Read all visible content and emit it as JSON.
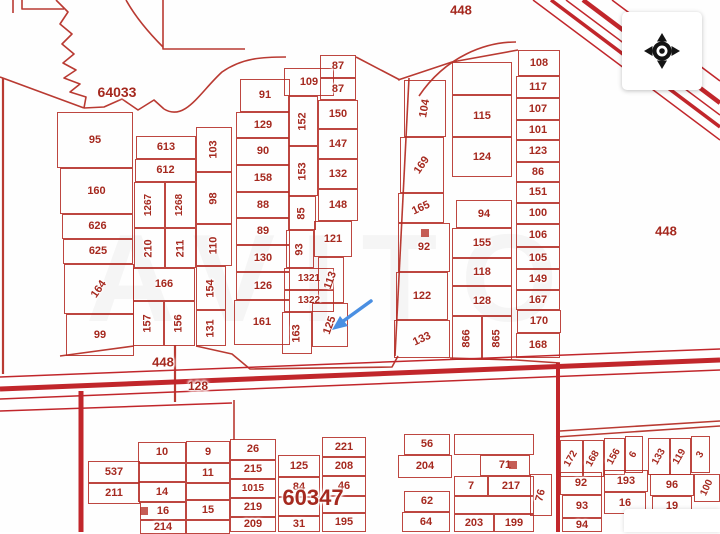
{
  "map": {
    "watermark_text": "AVITO",
    "colors": {
      "parcel_line": "#b42c25",
      "label": "#a5291f",
      "road": "#c01d23",
      "arrow": "#4a8fe2",
      "compass_icon": "#141414"
    },
    "region_labels": [
      {
        "text": "64033",
        "x": 117,
        "y": 92,
        "fs": 14
      },
      {
        "text": "448",
        "x": 461,
        "y": 10,
        "fs": 13
      },
      {
        "text": "448",
        "x": 666,
        "y": 231,
        "fs": 13
      },
      {
        "text": "448",
        "x": 163,
        "y": 362,
        "fs": 13
      },
      {
        "text": "128",
        "x": 198,
        "y": 386,
        "fs": 12
      },
      {
        "text": "60347",
        "x": 313,
        "y": 498,
        "fs": 22
      }
    ],
    "plots": [
      {
        "t": "95",
        "x": 57,
        "y": 112,
        "w": 76,
        "h": 56
      },
      {
        "t": "160",
        "x": 60,
        "y": 168,
        "w": 73,
        "h": 46
      },
      {
        "t": "626",
        "x": 62,
        "y": 214,
        "w": 71,
        "h": 25
      },
      {
        "t": "625",
        "x": 63,
        "y": 239,
        "w": 70,
        "h": 25
      },
      {
        "t": "164",
        "x": 64,
        "y": 264,
        "w": 70,
        "h": 50,
        "r": -55
      },
      {
        "t": "99",
        "x": 66,
        "y": 314,
        "w": 68,
        "h": 42
      },
      {
        "t": "613",
        "x": 136,
        "y": 136,
        "w": 60,
        "h": 23
      },
      {
        "t": "612",
        "x": 135,
        "y": 159,
        "w": 61,
        "h": 23
      },
      {
        "t": "1267",
        "x": 134,
        "y": 182,
        "w": 31,
        "h": 46,
        "r": -90,
        "fs": 10
      },
      {
        "t": "1268",
        "x": 165,
        "y": 182,
        "w": 31,
        "h": 46,
        "r": -90,
        "fs": 10
      },
      {
        "t": "210",
        "x": 134,
        "y": 228,
        "w": 31,
        "h": 40,
        "r": -90
      },
      {
        "t": "211",
        "x": 165,
        "y": 228,
        "w": 31,
        "h": 40,
        "r": -90
      },
      {
        "t": "166",
        "x": 133,
        "y": 268,
        "w": 62,
        "h": 33
      },
      {
        "t": "157",
        "x": 133,
        "y": 301,
        "w": 31,
        "h": 45,
        "r": -90
      },
      {
        "t": "156",
        "x": 164,
        "y": 301,
        "w": 31,
        "h": 45,
        "r": -90
      },
      {
        "t": "103",
        "x": 196,
        "y": 127,
        "w": 36,
        "h": 45,
        "r": -90
      },
      {
        "t": "98",
        "x": 196,
        "y": 172,
        "w": 36,
        "h": 52,
        "r": -90
      },
      {
        "t": "110",
        "x": 196,
        "y": 224,
        "w": 36,
        "h": 42,
        "r": -90
      },
      {
        "t": "154",
        "x": 196,
        "y": 266,
        "w": 30,
        "h": 44,
        "r": -90
      },
      {
        "t": "131",
        "x": 196,
        "y": 310,
        "w": 30,
        "h": 36,
        "r": -90
      },
      {
        "t": "91",
        "x": 240,
        "y": 79,
        "w": 50,
        "h": 33
      },
      {
        "t": "129",
        "x": 236,
        "y": 112,
        "w": 54,
        "h": 26
      },
      {
        "t": "90",
        "x": 236,
        "y": 138,
        "w": 54,
        "h": 27
      },
      {
        "t": "158",
        "x": 236,
        "y": 165,
        "w": 54,
        "h": 27
      },
      {
        "t": "88",
        "x": 236,
        "y": 192,
        "w": 54,
        "h": 26
      },
      {
        "t": "89",
        "x": 236,
        "y": 218,
        "w": 54,
        "h": 27
      },
      {
        "t": "130",
        "x": 236,
        "y": 245,
        "w": 54,
        "h": 27
      },
      {
        "t": "126",
        "x": 236,
        "y": 272,
        "w": 54,
        "h": 28
      },
      {
        "t": "161",
        "x": 234,
        "y": 300,
        "w": 56,
        "h": 45
      },
      {
        "t": "109",
        "x": 284,
        "y": 68,
        "w": 50,
        "h": 28
      },
      {
        "t": "87",
        "x": 320,
        "y": 55,
        "w": 36,
        "h": 23
      },
      {
        "t": "87",
        "x": 320,
        "y": 78,
        "w": 36,
        "h": 22
      },
      {
        "t": "152",
        "x": 288,
        "y": 96,
        "w": 30,
        "h": 50,
        "r": -90
      },
      {
        "t": "150",
        "x": 318,
        "y": 100,
        "w": 40,
        "h": 29
      },
      {
        "t": "153",
        "x": 288,
        "y": 146,
        "w": 30,
        "h": 50,
        "r": -90
      },
      {
        "t": "147",
        "x": 318,
        "y": 129,
        "w": 40,
        "h": 30
      },
      {
        "t": "132",
        "x": 318,
        "y": 159,
        "w": 40,
        "h": 30
      },
      {
        "t": "85",
        "x": 288,
        "y": 196,
        "w": 28,
        "h": 34,
        "r": -90
      },
      {
        "t": "148",
        "x": 318,
        "y": 189,
        "w": 40,
        "h": 32
      },
      {
        "t": "93",
        "x": 286,
        "y": 230,
        "w": 28,
        "h": 38,
        "r": -90
      },
      {
        "t": "121",
        "x": 314,
        "y": 221,
        "w": 38,
        "h": 36
      },
      {
        "t": "1321",
        "x": 284,
        "y": 268,
        "w": 50,
        "h": 22,
        "fs": 10
      },
      {
        "t": "113",
        "x": 318,
        "y": 257,
        "w": 26,
        "h": 46,
        "r": -70
      },
      {
        "t": "1322",
        "x": 284,
        "y": 290,
        "w": 50,
        "h": 22,
        "fs": 10
      },
      {
        "t": "163",
        "x": 282,
        "y": 312,
        "w": 30,
        "h": 42,
        "r": -90
      },
      {
        "t": "125",
        "x": 312,
        "y": 303,
        "w": 36,
        "h": 44,
        "r": -70
      },
      {
        "t": "104",
        "x": 404,
        "y": 80,
        "w": 42,
        "h": 57,
        "r": -80
      },
      {
        "t": "169",
        "x": 400,
        "y": 137,
        "w": 44,
        "h": 56,
        "r": -55
      },
      {
        "t": "165",
        "x": 398,
        "y": 193,
        "w": 46,
        "h": 30,
        "r": -25
      },
      {
        "t": "92",
        "x": 398,
        "y": 223,
        "w": 52,
        "h": 49
      },
      {
        "t": "122",
        "x": 396,
        "y": 272,
        "w": 52,
        "h": 48
      },
      {
        "t": "133",
        "x": 394,
        "y": 320,
        "w": 56,
        "h": 38,
        "r": -25
      },
      {
        "t": "",
        "x": 452,
        "y": 62,
        "w": 60,
        "h": 33
      },
      {
        "t": "115",
        "x": 452,
        "y": 95,
        "w": 60,
        "h": 42
      },
      {
        "t": "124",
        "x": 452,
        "y": 137,
        "w": 60,
        "h": 40
      },
      {
        "t": "94",
        "x": 456,
        "y": 200,
        "w": 56,
        "h": 28
      },
      {
        "t": "155",
        "x": 452,
        "y": 228,
        "w": 60,
        "h": 30
      },
      {
        "t": "118",
        "x": 452,
        "y": 258,
        "w": 60,
        "h": 28
      },
      {
        "t": "128",
        "x": 452,
        "y": 286,
        "w": 60,
        "h": 30
      },
      {
        "t": "866",
        "x": 452,
        "y": 316,
        "w": 30,
        "h": 44,
        "r": -90
      },
      {
        "t": "865",
        "x": 482,
        "y": 316,
        "w": 30,
        "h": 44,
        "r": -90
      },
      {
        "t": "108",
        "x": 518,
        "y": 50,
        "w": 42,
        "h": 26
      },
      {
        "t": "117",
        "x": 516,
        "y": 76,
        "w": 44,
        "h": 22
      },
      {
        "t": "107",
        "x": 516,
        "y": 98,
        "w": 44,
        "h": 22
      },
      {
        "t": "101",
        "x": 516,
        "y": 120,
        "w": 44,
        "h": 20
      },
      {
        "t": "123",
        "x": 516,
        "y": 140,
        "w": 44,
        "h": 22
      },
      {
        "t": "86",
        "x": 516,
        "y": 162,
        "w": 44,
        "h": 20
      },
      {
        "t": "151",
        "x": 516,
        "y": 182,
        "w": 44,
        "h": 21
      },
      {
        "t": "100",
        "x": 516,
        "y": 203,
        "w": 44,
        "h": 21
      },
      {
        "t": "106",
        "x": 516,
        "y": 224,
        "w": 44,
        "h": 23
      },
      {
        "t": "105",
        "x": 516,
        "y": 247,
        "w": 44,
        "h": 22
      },
      {
        "t": "149",
        "x": 516,
        "y": 269,
        "w": 44,
        "h": 21
      },
      {
        "t": "167",
        "x": 516,
        "y": 290,
        "w": 44,
        "h": 20
      },
      {
        "t": "170",
        "x": 517,
        "y": 310,
        "w": 44,
        "h": 23
      },
      {
        "t": "168",
        "x": 516,
        "y": 333,
        "w": 44,
        "h": 25
      },
      {
        "t": "537",
        "x": 88,
        "y": 461,
        "w": 52,
        "h": 22
      },
      {
        "t": "211",
        "x": 88,
        "y": 483,
        "w": 52,
        "h": 21
      },
      {
        "t": "10",
        "x": 138,
        "y": 442,
        "w": 48,
        "h": 21
      },
      {
        "t": "",
        "x": 138,
        "y": 463,
        "w": 48,
        "h": 19
      },
      {
        "t": "14",
        "x": 138,
        "y": 482,
        "w": 48,
        "h": 20
      },
      {
        "t": "16",
        "x": 140,
        "y": 502,
        "w": 46,
        "h": 18
      },
      {
        "t": "214",
        "x": 140,
        "y": 520,
        "w": 46,
        "h": 14
      },
      {
        "t": "9",
        "x": 186,
        "y": 441,
        "w": 44,
        "h": 22
      },
      {
        "t": "11",
        "x": 186,
        "y": 463,
        "w": 44,
        "h": 20
      },
      {
        "t": "",
        "x": 186,
        "y": 483,
        "w": 44,
        "h": 17
      },
      {
        "t": "15",
        "x": 186,
        "y": 500,
        "w": 44,
        "h": 20
      },
      {
        "t": "",
        "x": 186,
        "y": 520,
        "w": 44,
        "h": 14
      },
      {
        "t": "26",
        "x": 230,
        "y": 439,
        "w": 46,
        "h": 21
      },
      {
        "t": "215",
        "x": 230,
        "y": 460,
        "w": 46,
        "h": 19
      },
      {
        "t": "1015",
        "x": 230,
        "y": 479,
        "w": 46,
        "h": 19,
        "fs": 10
      },
      {
        "t": "219",
        "x": 230,
        "y": 498,
        "w": 46,
        "h": 19
      },
      {
        "t": "209",
        "x": 230,
        "y": 517,
        "w": 46,
        "h": 15
      },
      {
        "t": "125",
        "x": 278,
        "y": 455,
        "w": 42,
        "h": 22
      },
      {
        "t": "84",
        "x": 278,
        "y": 477,
        "w": 42,
        "h": 20
      },
      {
        "t": "",
        "x": 278,
        "y": 497,
        "w": 42,
        "h": 19
      },
      {
        "t": "31",
        "x": 278,
        "y": 516,
        "w": 42,
        "h": 16
      },
      {
        "t": "221",
        "x": 322,
        "y": 437,
        "w": 44,
        "h": 20
      },
      {
        "t": "208",
        "x": 322,
        "y": 457,
        "w": 44,
        "h": 19
      },
      {
        "t": "46",
        "x": 322,
        "y": 476,
        "w": 44,
        "h": 20
      },
      {
        "t": "",
        "x": 322,
        "y": 496,
        "w": 44,
        "h": 17
      },
      {
        "t": "195",
        "x": 322,
        "y": 513,
        "w": 44,
        "h": 19
      },
      {
        "t": "56",
        "x": 404,
        "y": 434,
        "w": 46,
        "h": 21
      },
      {
        "t": "204",
        "x": 398,
        "y": 455,
        "w": 54,
        "h": 23
      },
      {
        "t": "62",
        "x": 404,
        "y": 491,
        "w": 46,
        "h": 21
      },
      {
        "t": "64",
        "x": 402,
        "y": 512,
        "w": 48,
        "h": 20
      },
      {
        "t": "",
        "x": 454,
        "y": 434,
        "w": 80,
        "h": 21
      },
      {
        "t": "71",
        "x": 480,
        "y": 455,
        "w": 50,
        "h": 21
      },
      {
        "t": "7",
        "x": 454,
        "y": 476,
        "w": 34,
        "h": 20
      },
      {
        "t": "217",
        "x": 488,
        "y": 476,
        "w": 46,
        "h": 20
      },
      {
        "t": "",
        "x": 454,
        "y": 496,
        "w": 80,
        "h": 18
      },
      {
        "t": "203",
        "x": 454,
        "y": 514,
        "w": 40,
        "h": 18
      },
      {
        "t": "199",
        "x": 494,
        "y": 514,
        "w": 40,
        "h": 18
      },
      {
        "t": "76",
        "x": 530,
        "y": 474,
        "w": 22,
        "h": 42,
        "r": -75
      },
      {
        "t": "172",
        "x": 560,
        "y": 440,
        "w": 23,
        "h": 37,
        "r": -60,
        "fs": 10
      },
      {
        "t": "168",
        "x": 583,
        "y": 440,
        "w": 21,
        "h": 37,
        "r": -60,
        "fs": 10
      },
      {
        "t": "156",
        "x": 604,
        "y": 438,
        "w": 21,
        "h": 37,
        "r": -60,
        "fs": 10
      },
      {
        "t": "6",
        "x": 625,
        "y": 436,
        "w": 18,
        "h": 37,
        "r": -60,
        "fs": 10
      },
      {
        "t": "133",
        "x": 648,
        "y": 438,
        "w": 22,
        "h": 37,
        "r": -60,
        "fs": 10
      },
      {
        "t": "119",
        "x": 670,
        "y": 438,
        "w": 21,
        "h": 37,
        "r": -60,
        "fs": 10
      },
      {
        "t": "3",
        "x": 691,
        "y": 436,
        "w": 19,
        "h": 37,
        "r": -60,
        "fs": 10
      },
      {
        "t": "92",
        "x": 560,
        "y": 472,
        "w": 42,
        "h": 23
      },
      {
        "t": "193",
        "x": 604,
        "y": 470,
        "w": 44,
        "h": 22
      },
      {
        "t": "96",
        "x": 650,
        "y": 474,
        "w": 44,
        "h": 22
      },
      {
        "t": "100",
        "x": 694,
        "y": 474,
        "w": 26,
        "h": 28,
        "r": -65,
        "fs": 10
      },
      {
        "t": "93",
        "x": 562,
        "y": 495,
        "w": 40,
        "h": 23
      },
      {
        "t": "16",
        "x": 604,
        "y": 492,
        "w": 42,
        "h": 22
      },
      {
        "t": "19",
        "x": 652,
        "y": 496,
        "w": 40,
        "h": 20
      },
      {
        "t": "94",
        "x": 562,
        "y": 518,
        "w": 40,
        "h": 14
      }
    ],
    "building_markers": [
      {
        "x": 140,
        "y": 507
      },
      {
        "x": 421,
        "y": 229
      },
      {
        "x": 509,
        "y": 461
      }
    ]
  }
}
